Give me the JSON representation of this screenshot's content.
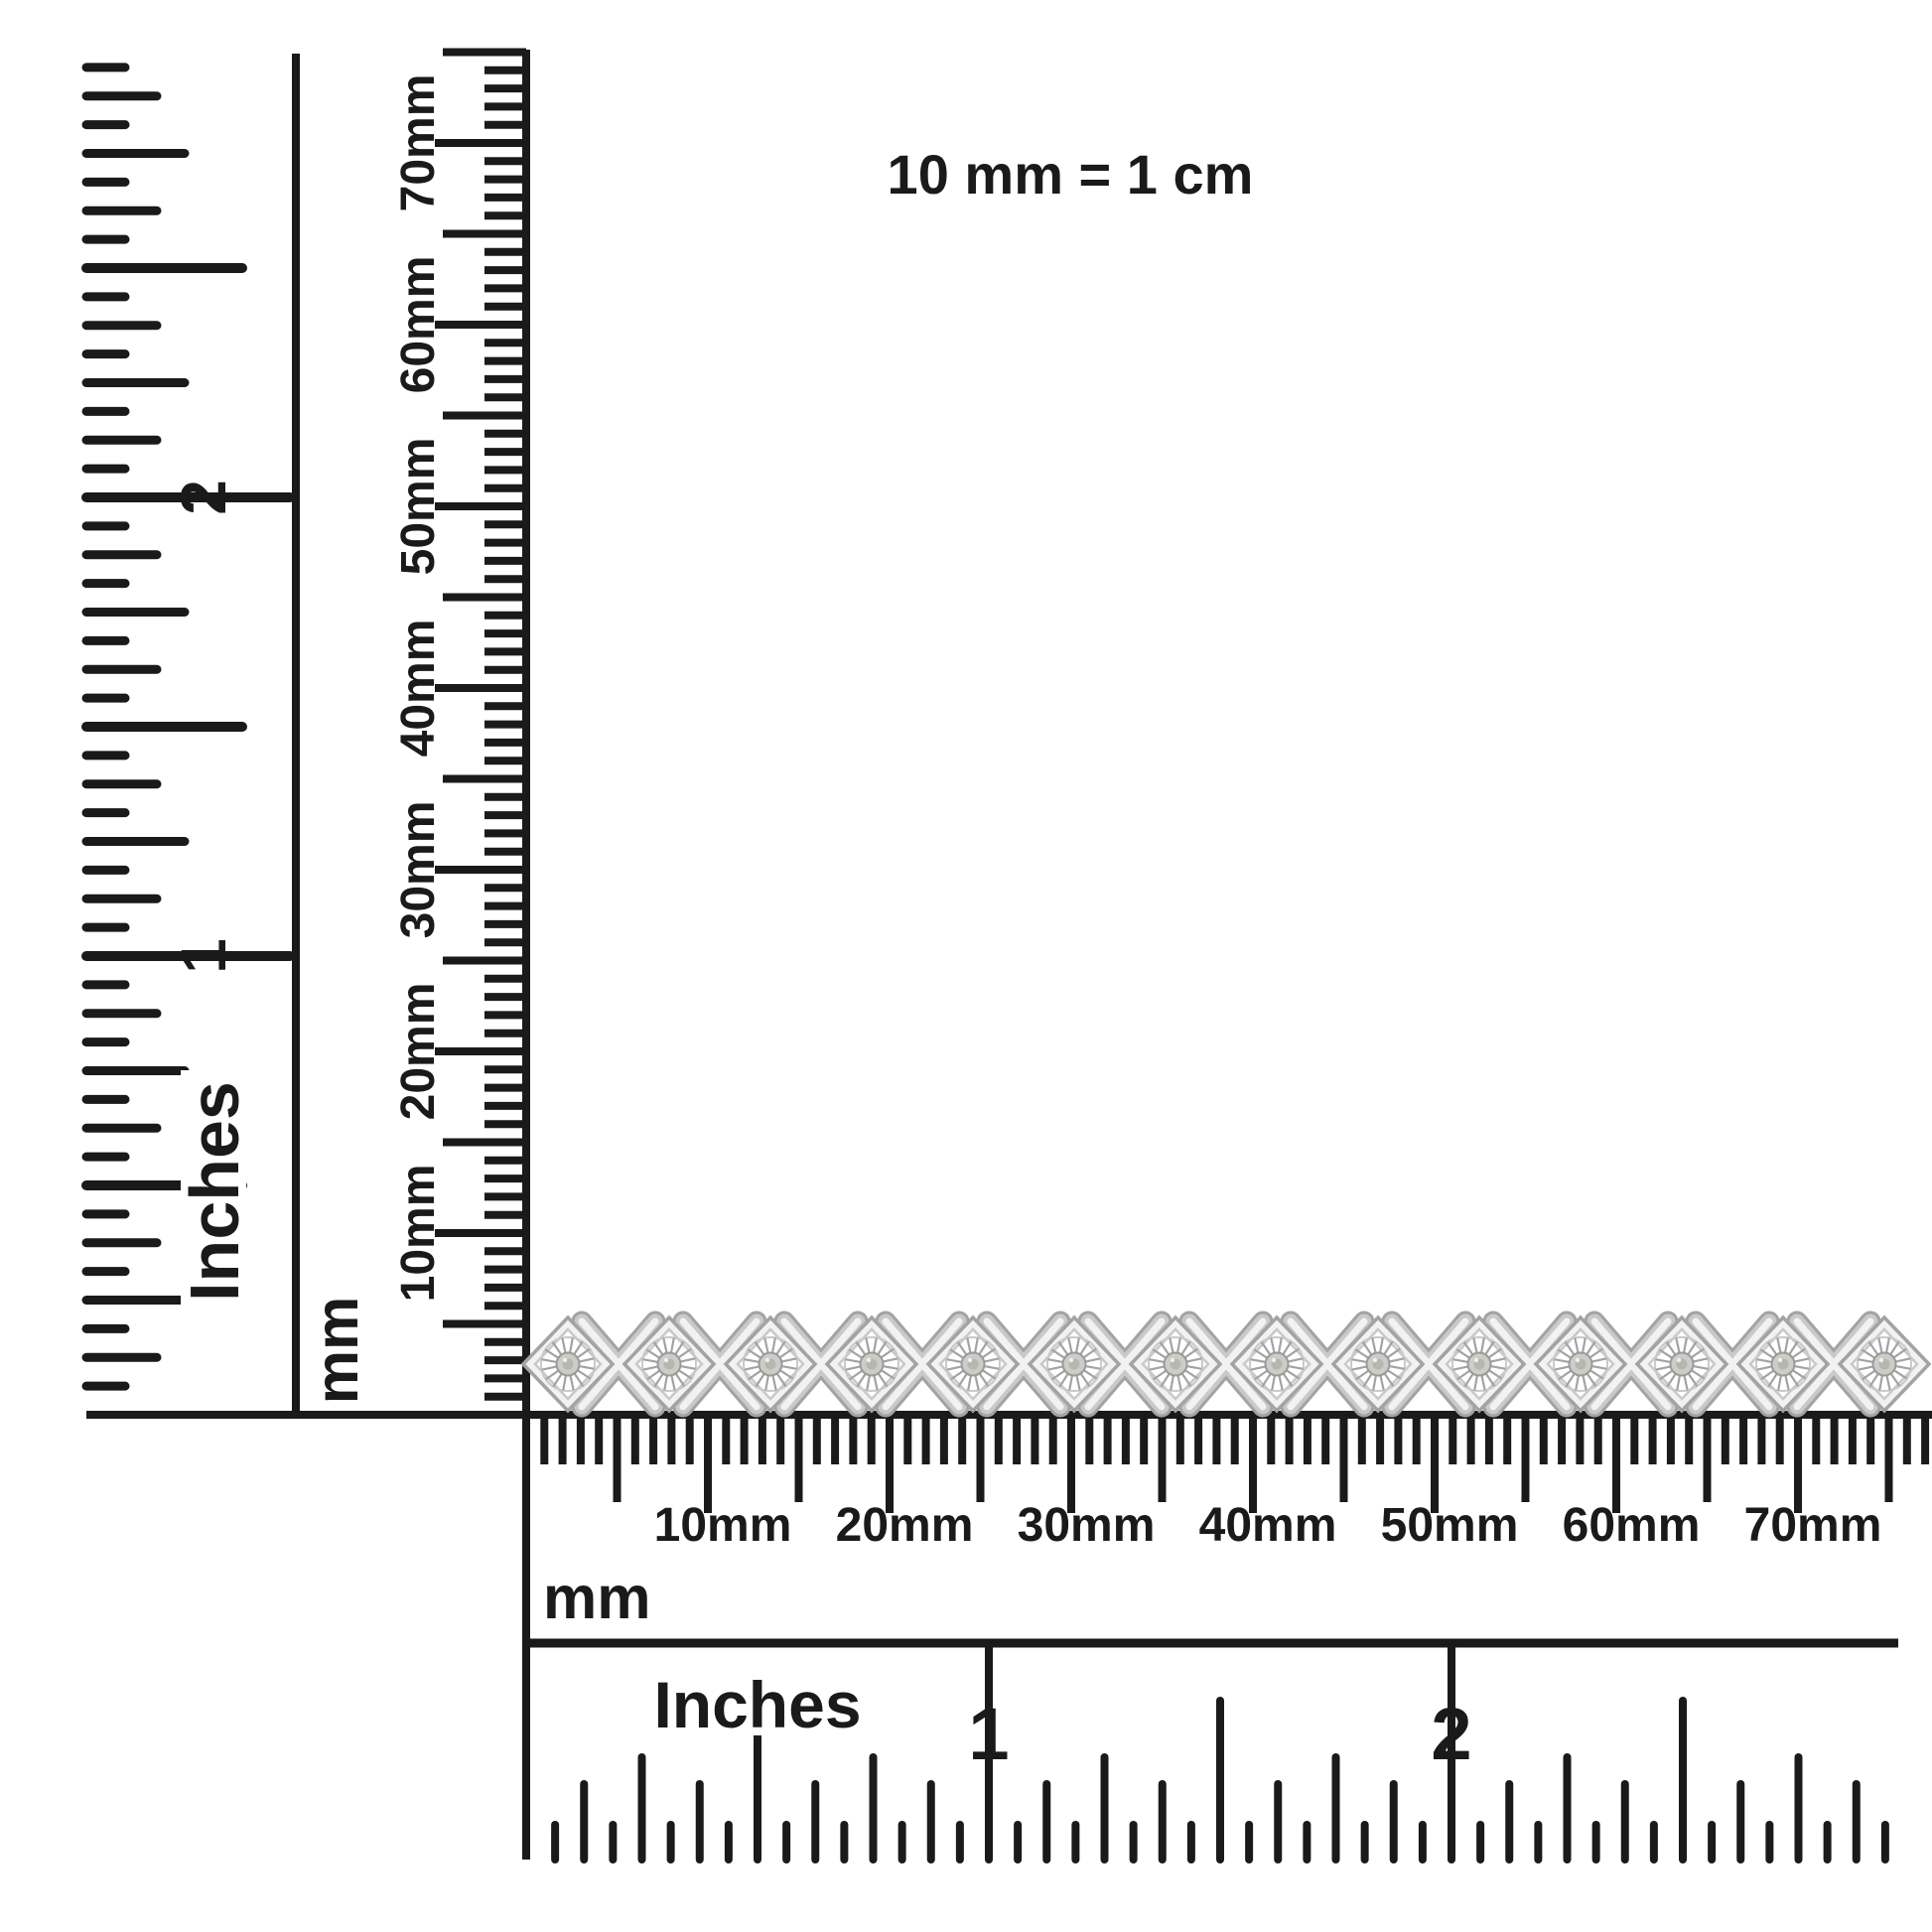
{
  "note": {
    "text": "10 mm = 1 cm"
  },
  "vertical_inches_ruler": {
    "unit": "Inches",
    "labels": [
      "1",
      "2"
    ]
  },
  "vertical_mm_ruler": {
    "unit": "mm",
    "labels": [
      "10mm",
      "20mm",
      "30mm",
      "40mm",
      "50mm",
      "60mm",
      "70mm"
    ]
  },
  "horizontal_mm_ruler": {
    "unit": "mm",
    "labels": [
      "10mm",
      "20mm",
      "30mm",
      "40mm",
      "50mm",
      "60mm",
      "70mm"
    ]
  },
  "horizontal_inches_ruler": {
    "unit": "Inches",
    "labels": [
      "1",
      "2"
    ]
  },
  "bracelet": {
    "station_count": 14
  },
  "colors": {
    "ink": "#1a1a1a",
    "background": "#ffffff",
    "metal_edge": "#a3a3a3",
    "metal_mid": "#c9c9c9",
    "metal_face": "#f2f2f2",
    "metal_highlight": "#ffffff",
    "stone": "#cdcdc7",
    "stone_dark": "#b7b7b0"
  }
}
